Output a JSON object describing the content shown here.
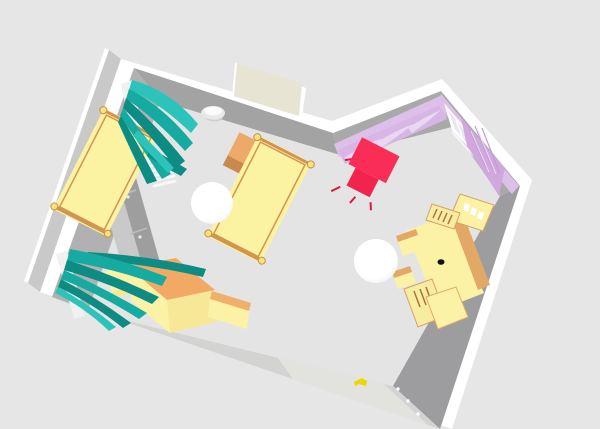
{
  "scene": {
    "background": "#e6e6e6",
    "floor": "#e4e4e4",
    "walls": {
      "top": "#ffffff",
      "outer_face": "#c9c9c9",
      "left": "#b1b1b2",
      "back": "#a3a3a4",
      "upper_right": "#a9a9aa",
      "window_wall": "#a9a9aa",
      "right": "#9d9da0",
      "front": "#d3d3d2"
    },
    "doors": {
      "back_panel": "#e7e4d4",
      "back_frame": "#ffffff",
      "front_panel": "#e2e2df",
      "front_handle": "#eed600",
      "hinge": "#fafafa"
    },
    "windows": {
      "left_frame": "#f1f1f1",
      "right_frame": "#ffffff",
      "right_glass": "#e9e7ee",
      "right_sill": "#f7f5fa"
    },
    "curtains": {
      "teal": "#15aba1",
      "teal_dark": "#0d8c84",
      "teal_light": "#2cc4ba",
      "lavender_valance": "#dcc0ea",
      "lavender_panel": "#d7b5e5",
      "lavender_textured": "#d0a8de",
      "lavender_highlight": "#ead7f3"
    },
    "bed": {
      "blanket": "#fbf2a2",
      "frame": "#d2954f",
      "knob": "#f6e37e",
      "knob_rim": "#c98f44"
    },
    "nightstand": {
      "top": "#eca969",
      "front": "#c9894c"
    },
    "wardrobe": {
      "top": "#c9c9c9",
      "front": "#9e9e9e",
      "divider": "#bdbdbd",
      "knob": "#e9e9e9"
    },
    "radiator": "#f7f7f7",
    "sconce": {
      "body": "#e8e8e8",
      "highlight": "#fbfbfb",
      "shadow": "#cfcfcf"
    },
    "sideboard": {
      "top": "#f2a963",
      "side": "#fcf2a6",
      "side_shaded": "#f7e897",
      "arm_top": "#f0b06a"
    },
    "desk": {
      "surface": "#fcf2a6",
      "trim": "#dca05e",
      "stripe": "#e2a866",
      "shelf_bg": "#f7eda0",
      "book": "#b0703c",
      "item_white": "#ffffff",
      "mouse": "#111111"
    },
    "chair": {
      "back": "#fa2d56",
      "seat": "#f2234c",
      "leg": "#d81b40"
    },
    "sphere": {
      "color": "#ffffff",
      "shade": "#ececec"
    }
  }
}
